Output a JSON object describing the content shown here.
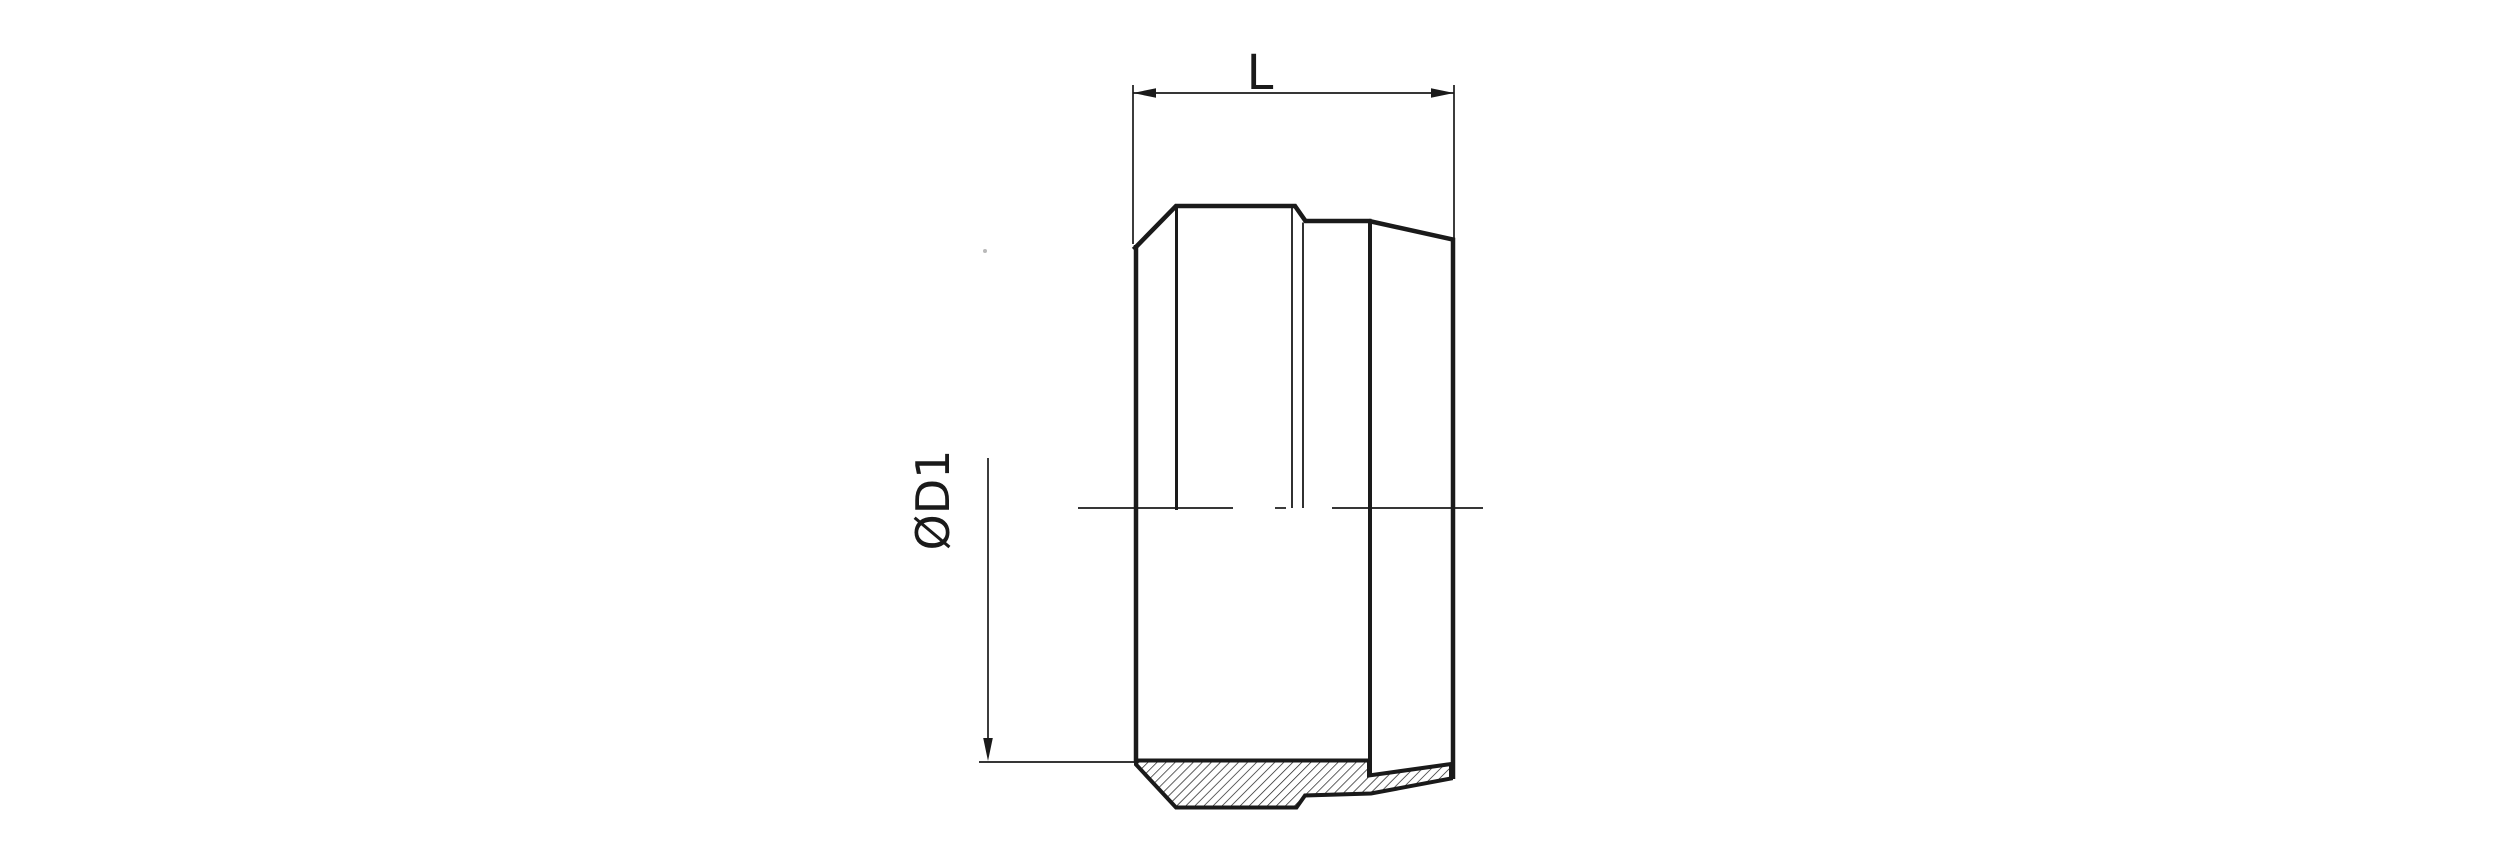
{
  "drawing": {
    "background_color": "#ffffff",
    "line_color": "#1a1a1a",
    "dimensions": {
      "length": {
        "label": "L"
      },
      "diameter": {
        "label": "ØD1"
      }
    }
  }
}
